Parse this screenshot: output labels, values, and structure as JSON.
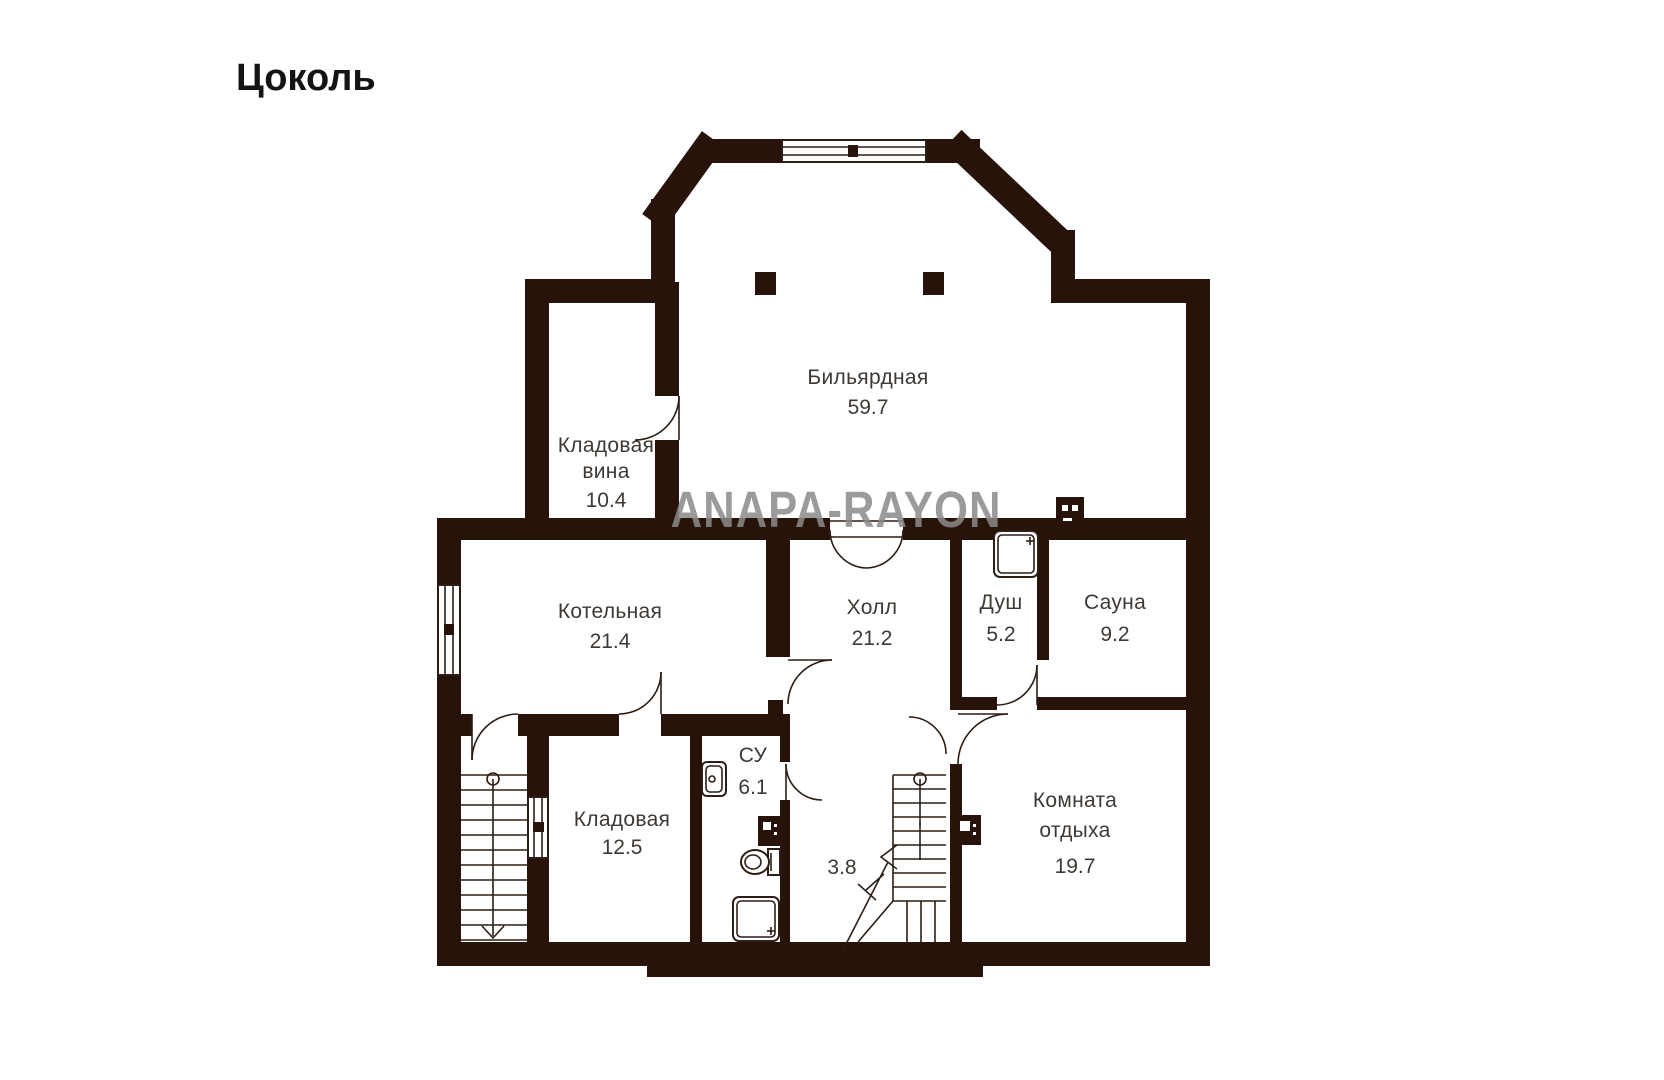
{
  "page": {
    "title": "Цоколь",
    "watermark": "ANAPA-RAYON"
  },
  "colors": {
    "wall": "#271309",
    "thin_line": "#2c1e14",
    "label_text": "#3e3934",
    "title_text": "#141414",
    "watermark_text": "#8a8a8a",
    "background": "#ffffff"
  },
  "rooms": [
    {
      "id": "billiard",
      "line1": "Бильярдная",
      "area": "59.7"
    },
    {
      "id": "wine-storage",
      "line1": "Кладовая",
      "line2": "вина",
      "area": "10.4"
    },
    {
      "id": "boiler",
      "line1": "Котельная",
      "area": "21.4"
    },
    {
      "id": "hall",
      "line1": "Холл",
      "area": "21.2"
    },
    {
      "id": "shower",
      "line1": "Душ",
      "area": "5.2"
    },
    {
      "id": "sauna",
      "line1": "Сауна",
      "area": "9.2"
    },
    {
      "id": "storage",
      "line1": "Кладовая",
      "area": "12.5"
    },
    {
      "id": "wc",
      "line1": "СУ",
      "area": "6.1"
    },
    {
      "id": "stair-landing",
      "area": "3.8"
    },
    {
      "id": "lounge",
      "line1": "Комната",
      "line2": "отдыха",
      "area": "19.7"
    }
  ],
  "icons": [
    "sink-icon",
    "toilet-icon",
    "shower-tray-icon",
    "sauna-stove-icon",
    "electrical-panel-icon",
    "stairs-down-icon",
    "stairs-up-icon",
    "door-arc-icon",
    "window-icon",
    "column-icon"
  ]
}
